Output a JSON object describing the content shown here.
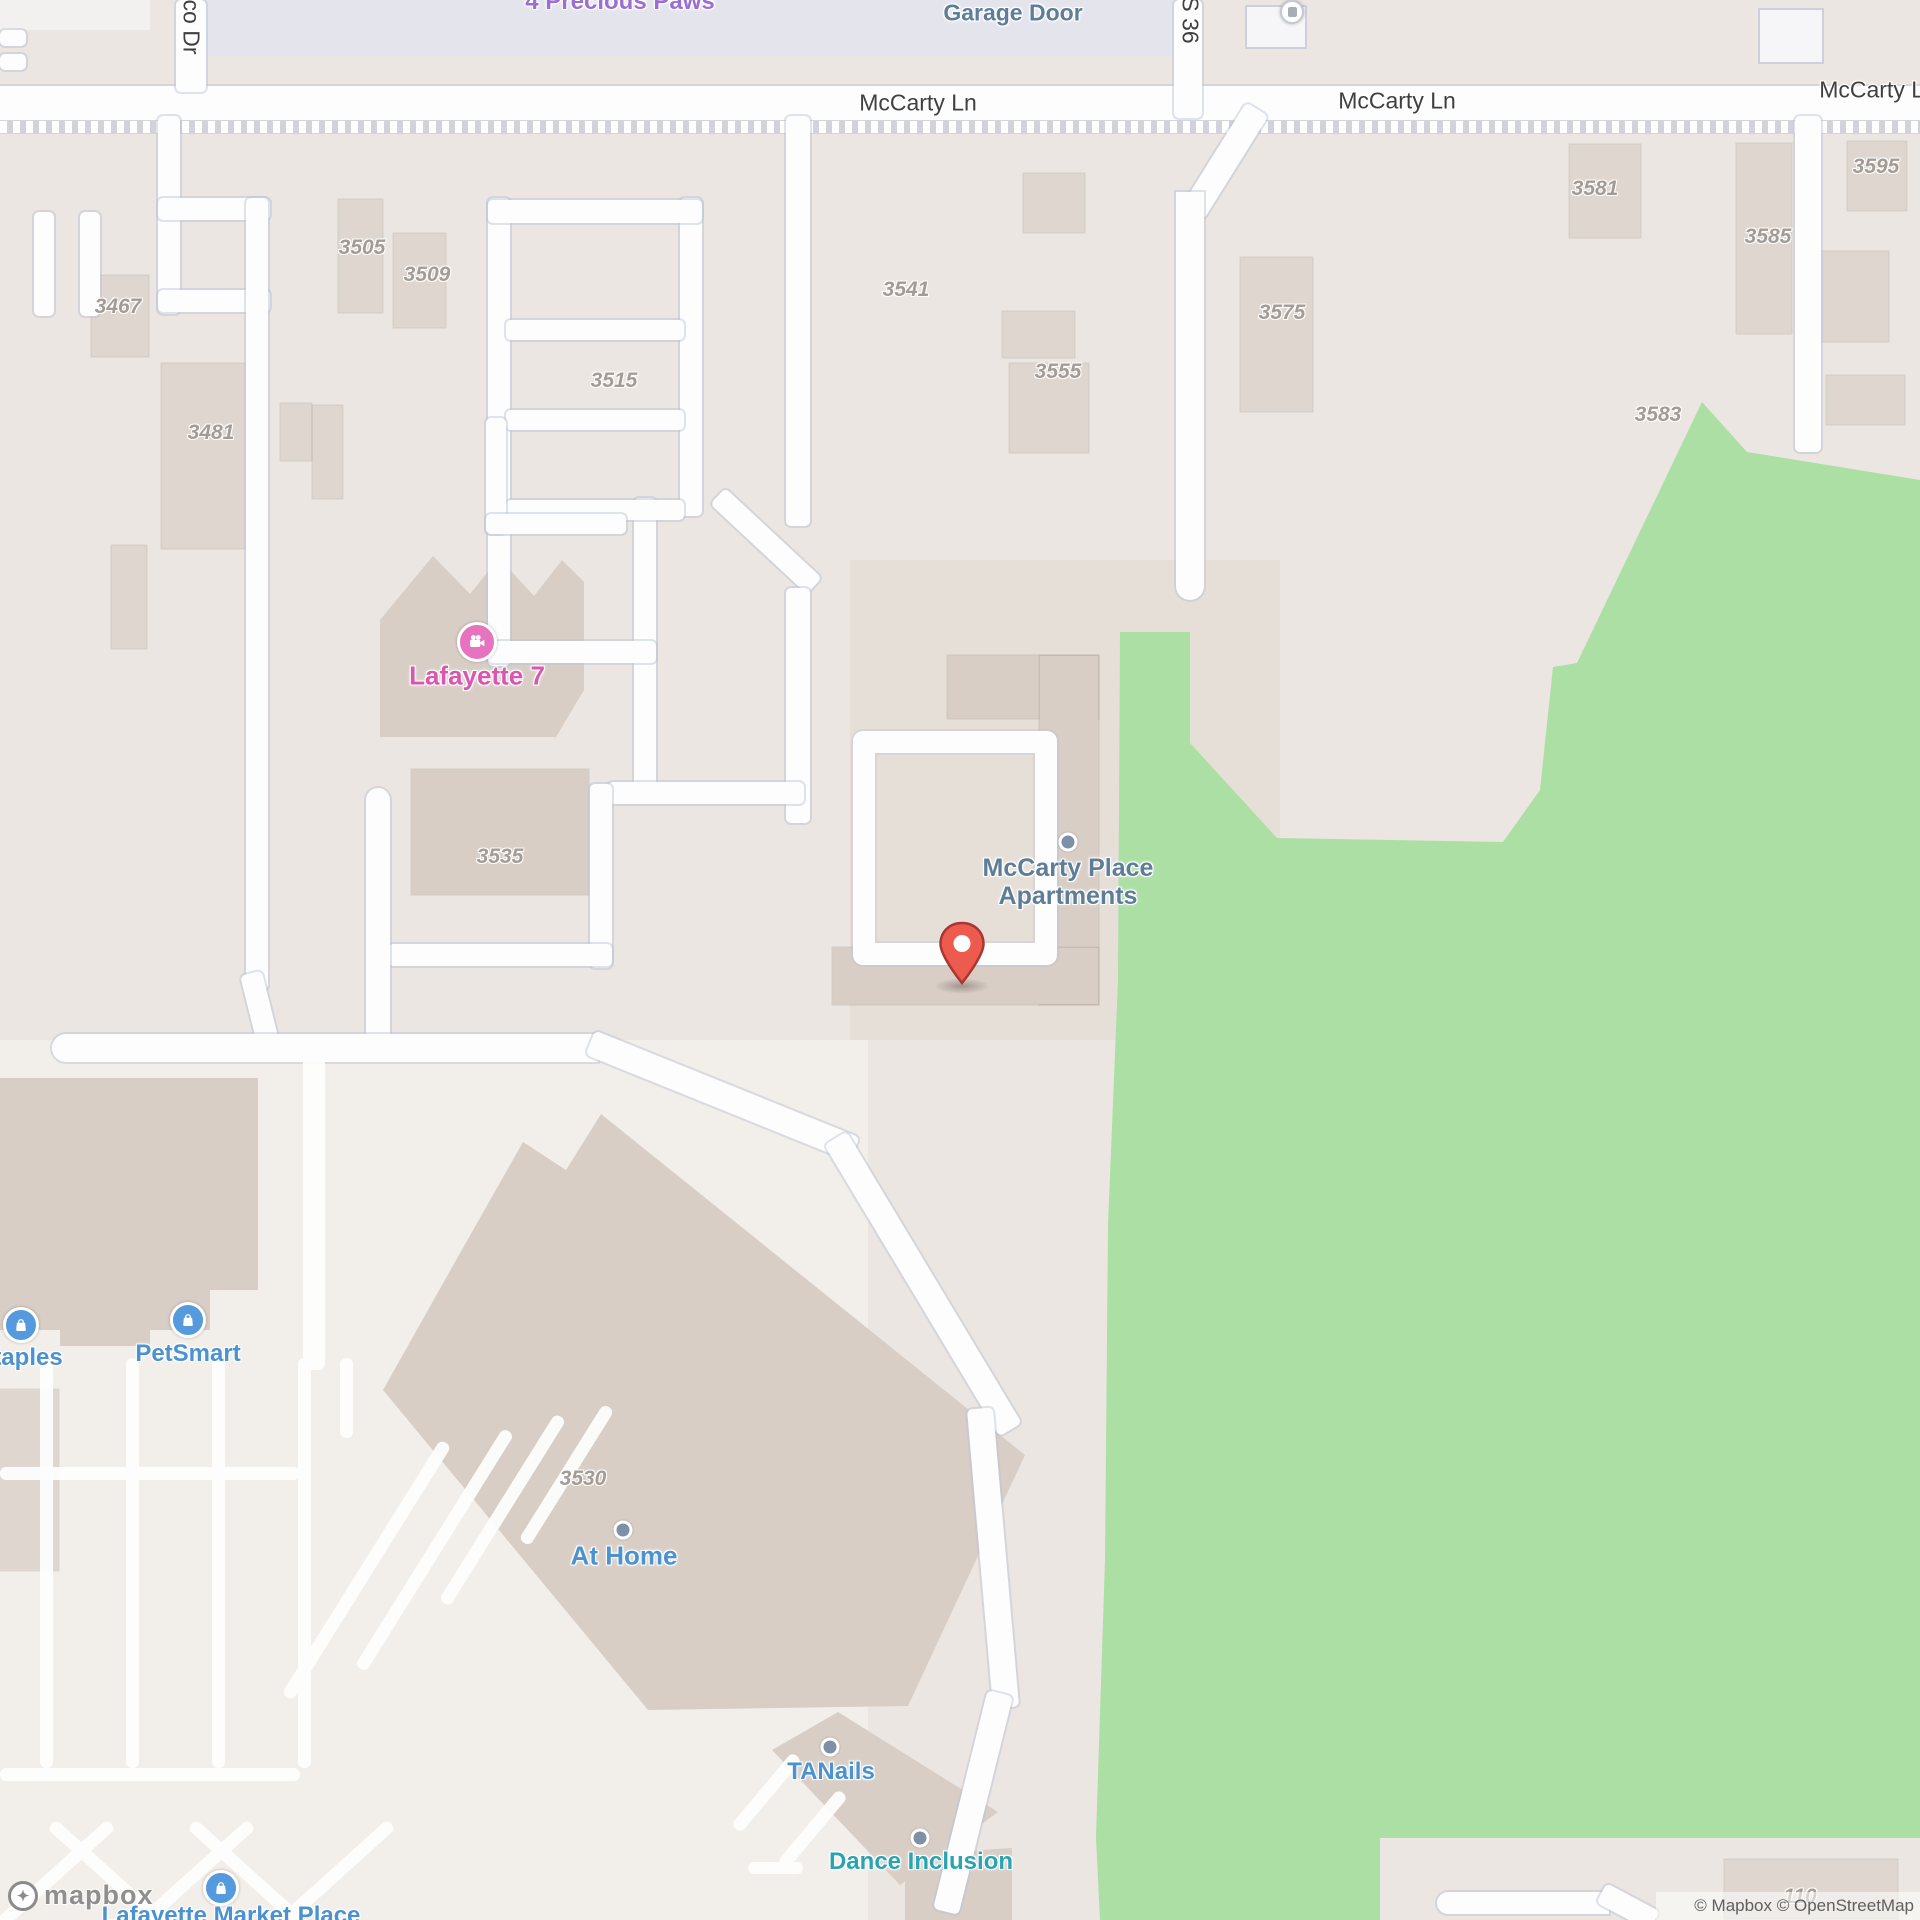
{
  "map": {
    "colors": {
      "background_beige": "#ebe6e1",
      "green_area": "#abdfa3",
      "road_white": "#fdfdfd",
      "building": "#ded6cf",
      "pin_red": "#ec5b50",
      "poi_blue": "#4b92cf",
      "poi_teal": "#2ba3b0",
      "poi_pink": "#d957ae",
      "poi_purple": "#9b6fd0",
      "poi_steel": "#5e7d98",
      "house_number_gray": "#a39b94"
    },
    "street_labels": [
      {
        "text": "McCarty Ln",
        "x": 918,
        "y": 103,
        "rot": 0
      },
      {
        "text": "McCarty Ln",
        "x": 1397,
        "y": 101,
        "rot": 0
      },
      {
        "text": "McCarty Ln",
        "x": 1878,
        "y": 90,
        "rot": 0
      },
      {
        "text": "co Dr",
        "x": 191,
        "y": 27,
        "rot": 90
      },
      {
        "text": "S 36",
        "x": 1190,
        "y": 20,
        "rot": 90
      }
    ],
    "house_numbers": [
      {
        "text": "3467",
        "x": 118,
        "y": 307
      },
      {
        "text": "3481",
        "x": 211,
        "y": 433
      },
      {
        "text": "3505",
        "x": 362,
        "y": 248
      },
      {
        "text": "3509",
        "x": 427,
        "y": 275
      },
      {
        "text": "3515",
        "x": 614,
        "y": 381
      },
      {
        "text": "3535",
        "x": 500,
        "y": 857
      },
      {
        "text": "3541",
        "x": 906,
        "y": 290
      },
      {
        "text": "3555",
        "x": 1058,
        "y": 372
      },
      {
        "text": "3575",
        "x": 1282,
        "y": 313
      },
      {
        "text": "3581",
        "x": 1595,
        "y": 189
      },
      {
        "text": "3583",
        "x": 1658,
        "y": 415
      },
      {
        "text": "3585",
        "x": 1768,
        "y": 237
      },
      {
        "text": "3595",
        "x": 1876,
        "y": 167
      },
      {
        "text": "3530",
        "x": 583,
        "y": 1479
      },
      {
        "text": "110",
        "x": 1800,
        "y": 1897
      }
    ],
    "pois": {
      "precious_paws": {
        "label": "4 Precious Paws"
      },
      "garage_door": {
        "label": "Garage Door"
      },
      "lafayette7": {
        "label": "Lafayette 7"
      },
      "mccarty_place": {
        "line1": "McCarty Place",
        "line2": "Apartments"
      },
      "petsmart": {
        "label": "PetSmart"
      },
      "staples": {
        "label": "taples"
      },
      "at_home": {
        "label": "At Home"
      },
      "tanails": {
        "label": "TANails"
      },
      "dance_inclusion": {
        "label": "Dance Inclusion"
      },
      "market_place": {
        "label": "Lafayette Market Place"
      }
    },
    "attribution": "© Mapbox © OpenStreetMap",
    "logo_text": "mapbox"
  }
}
